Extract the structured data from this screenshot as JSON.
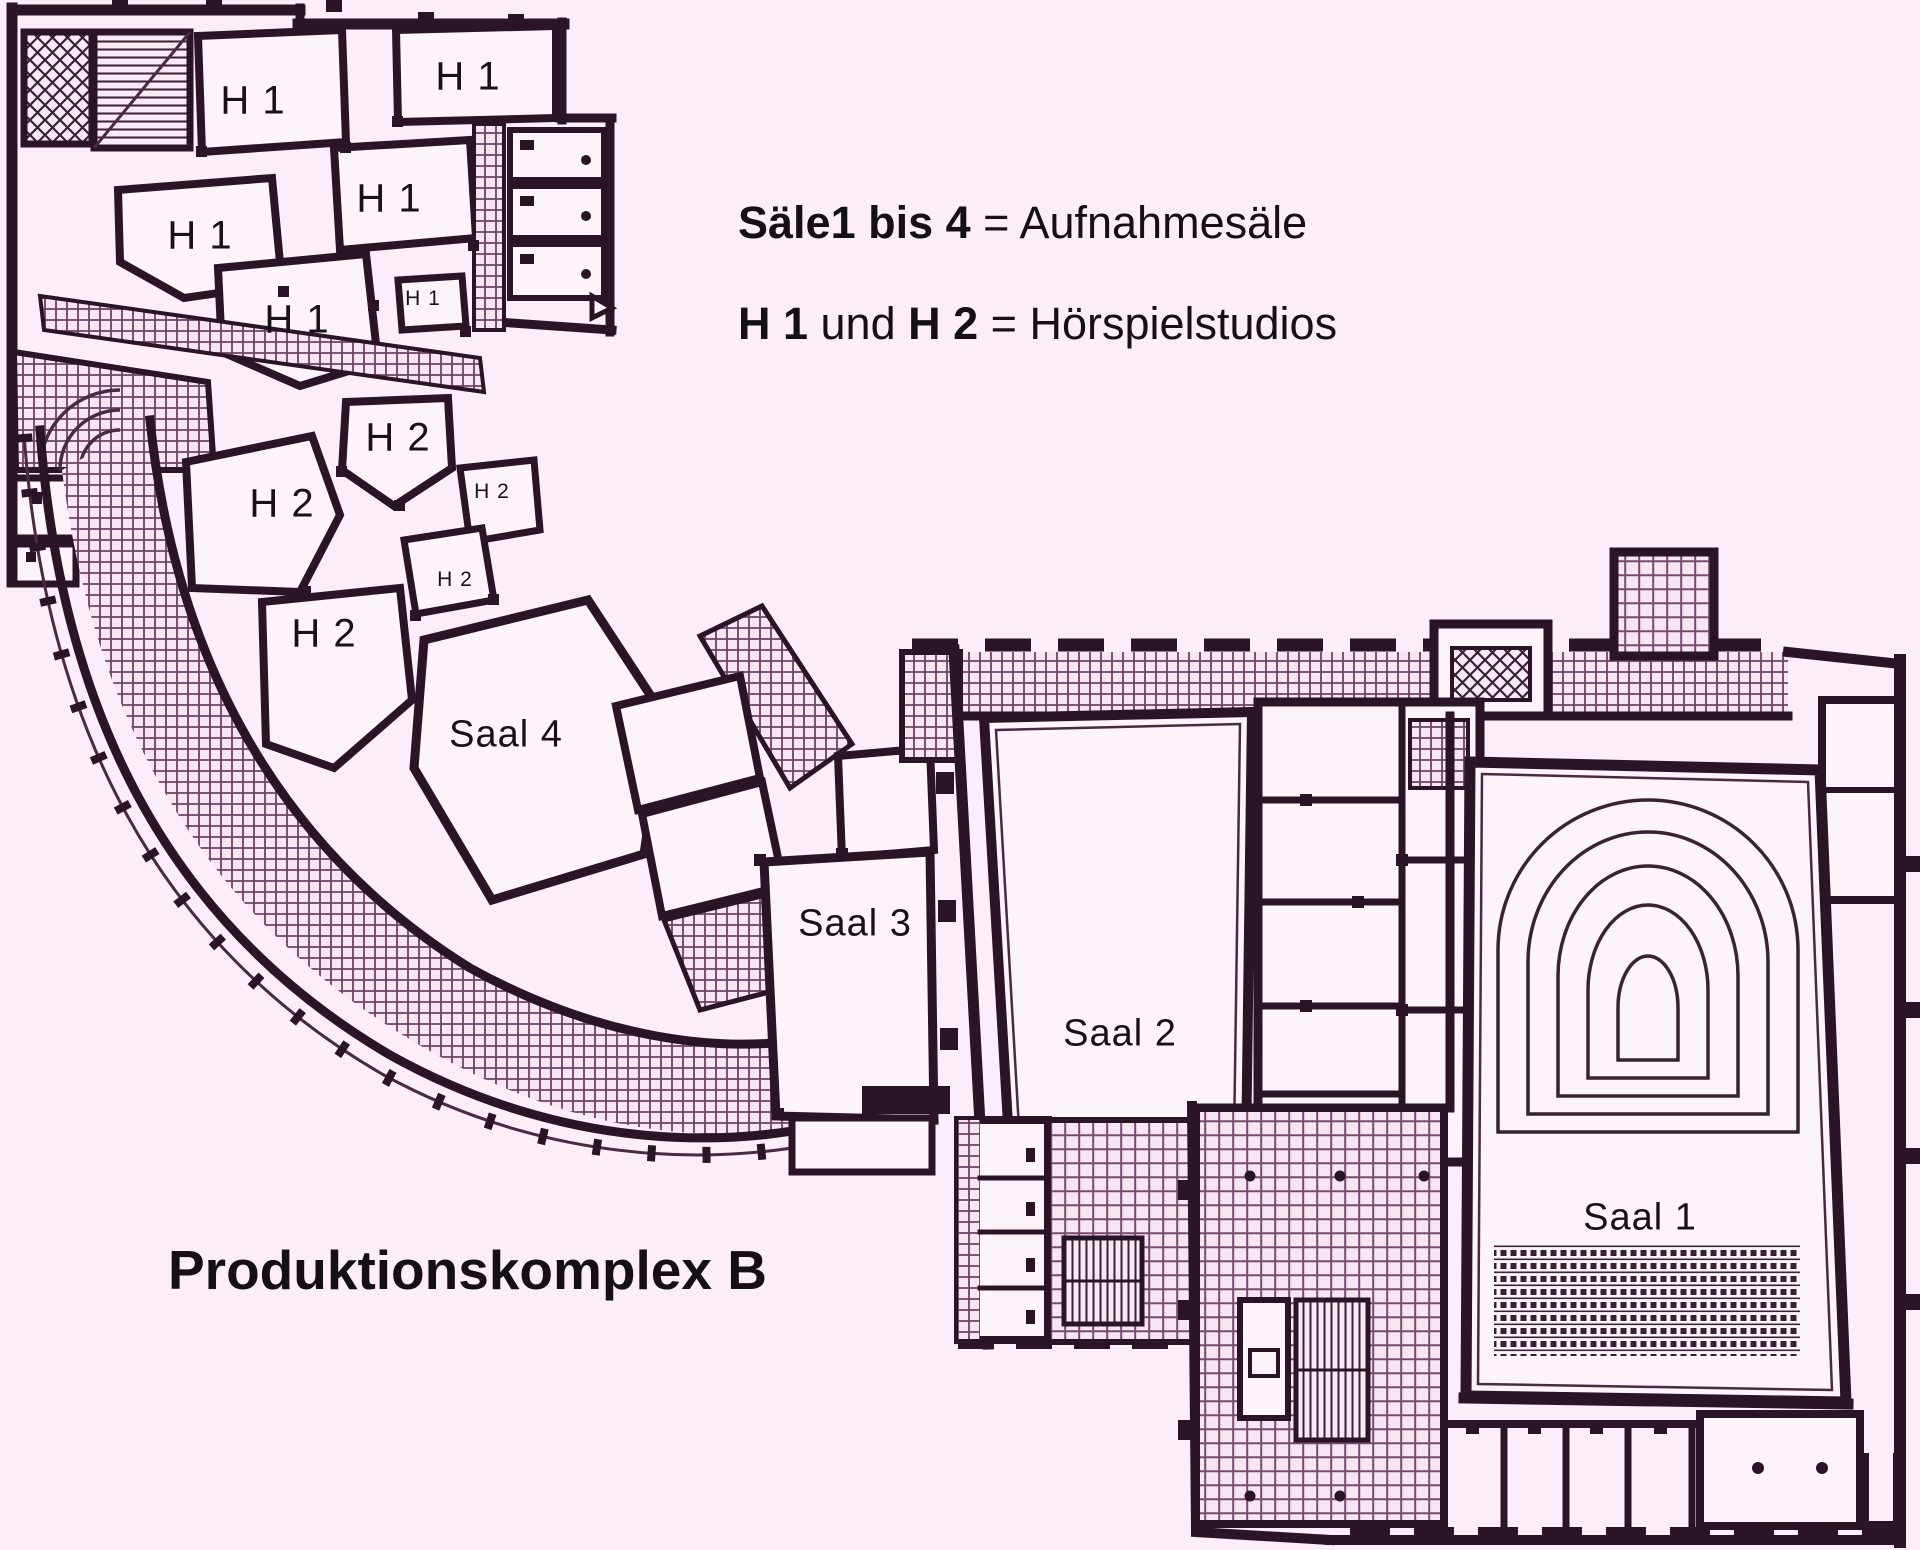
{
  "page": {
    "background_color": "#fceef9",
    "wall_color": "#2a1426",
    "hatch_color": "#6e4261",
    "text_color": "#141016"
  },
  "legend": {
    "line1_bold": "Säle1 bis 4",
    "line1_rest": " = Aufnahmesäle",
    "line2_bold1": "H 1",
    "line2_mid": " und ",
    "line2_bold2": "H 2",
    "line2_rest": " = Hörspielstudios"
  },
  "caption": {
    "text": "Produktionskomplex B"
  },
  "plan": {
    "labels": [
      {
        "name": "room-label-h1-1",
        "text": "H 1",
        "x": 253,
        "y": 101,
        "size": 40
      },
      {
        "name": "room-label-h1-2",
        "text": "H 1",
        "x": 468,
        "y": 77,
        "size": 40
      },
      {
        "name": "room-label-h1-3",
        "text": "H 1",
        "x": 389,
        "y": 199,
        "size": 40
      },
      {
        "name": "room-label-h1-4",
        "text": "H 1",
        "x": 200,
        "y": 236,
        "size": 40
      },
      {
        "name": "room-label-h1-5",
        "text": "H 1",
        "x": 297,
        "y": 320,
        "size": 40
      },
      {
        "name": "room-label-h1-6",
        "text": "H 1",
        "x": 423,
        "y": 299,
        "size": 21
      },
      {
        "name": "room-label-h2-1",
        "text": "H 2",
        "x": 398,
        "y": 438,
        "size": 40
      },
      {
        "name": "room-label-h2-2",
        "text": "H 2",
        "x": 282,
        "y": 504,
        "size": 40
      },
      {
        "name": "room-label-h2-3",
        "text": "H 2",
        "x": 492,
        "y": 492,
        "size": 21
      },
      {
        "name": "room-label-h2-4",
        "text": "H 2",
        "x": 455,
        "y": 580,
        "size": 21
      },
      {
        "name": "room-label-h2-5",
        "text": "H 2",
        "x": 324,
        "y": 634,
        "size": 40
      },
      {
        "name": "room-label-saal4",
        "text": "Saal 4",
        "x": 506,
        "y": 735,
        "size": 38
      },
      {
        "name": "room-label-saal3",
        "text": "Saal 3",
        "x": 855,
        "y": 924,
        "size": 38
      },
      {
        "name": "room-label-saal2",
        "text": "Saal 2",
        "x": 1120,
        "y": 1034,
        "size": 38
      },
      {
        "name": "room-label-saal1",
        "text": "Saal 1",
        "x": 1640,
        "y": 1218,
        "size": 38
      }
    ]
  }
}
